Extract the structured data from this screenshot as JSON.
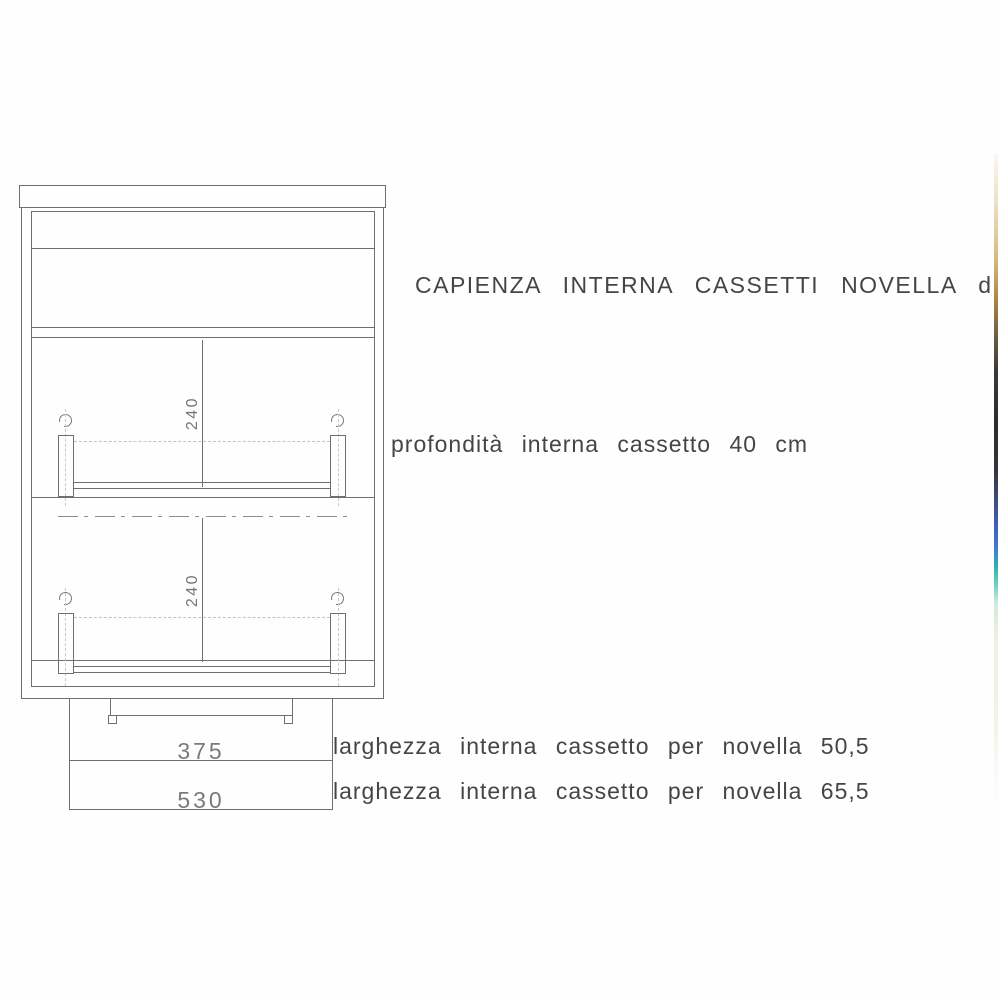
{
  "document": {
    "title": "CAPIENZA INTERNA CASSETTI NOVELLA dipiù",
    "notes": {
      "depth": "profondità interna cassetto 40 cm",
      "width_small": "larghezza interna cassetto per novella 50,5",
      "width_large": "larghezza interna cassetto per novella 65,5"
    },
    "dimensions": {
      "top_drawer_height": "240",
      "bottom_drawer_height": "240",
      "inner_width": "375",
      "outer_width": "530"
    },
    "colors": {
      "line": "#6f6f6f",
      "label_text": "#454545",
      "dimension_text": "#7a7a7a",
      "background": "#fefefe",
      "edge_strip_tan": "#d8b97c",
      "edge_strip_dark": "#2e2c2b",
      "edge_strip_blue": "#3f62c4",
      "edge_strip_teal": "#2fb3a8"
    }
  }
}
